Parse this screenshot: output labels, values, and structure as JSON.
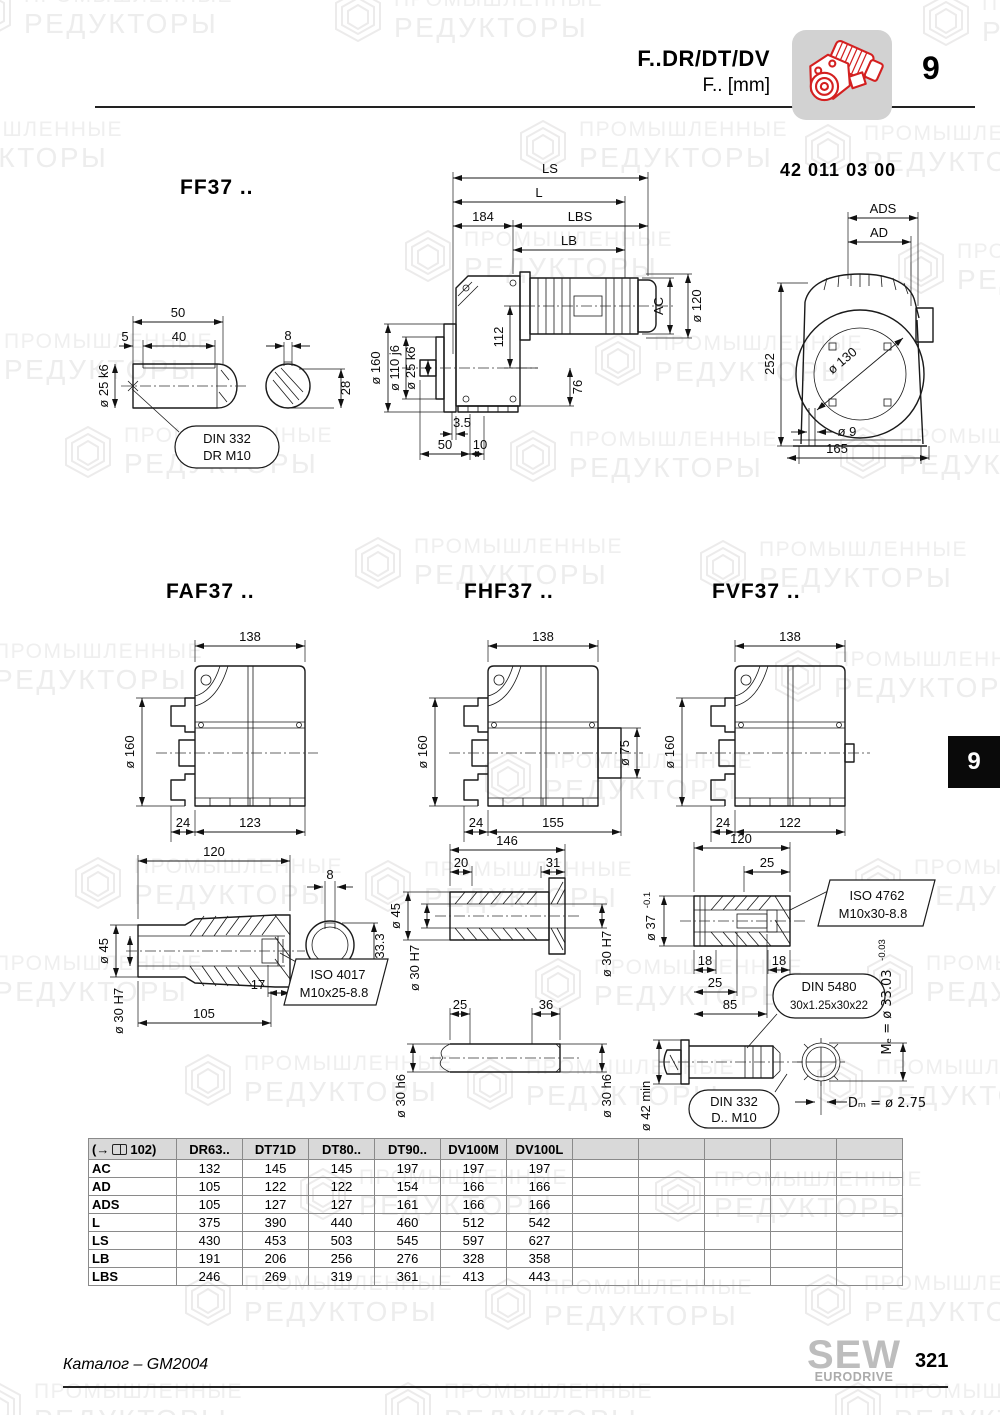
{
  "header": {
    "title1": "F..DR/DT/DV",
    "title2": "F.. [mm]",
    "chapter": "9",
    "part_number": "42 011 03 00"
  },
  "watermark": {
    "line1": "ПРОМЫШЛЕННЫЕ",
    "line2": "РЕДУКТОРЫ"
  },
  "drawings": {
    "ff37": {
      "label": "FF37 ..",
      "shaft": {
        "d50": "50",
        "d5": "5",
        "d40": "40",
        "dia25": "ø 25 k6",
        "d8": "8",
        "d28": "28",
        "callout": [
          "DIN 332",
          "DR M10"
        ]
      },
      "side": {
        "ls": "LS",
        "l": "L",
        "d184": "184",
        "lbs": "LBS",
        "lb": "LB",
        "ac": "AC",
        "dia120": "ø 120",
        "dia160": "ø 160",
        "dia110": "ø 110 j6",
        "dia25": "ø 25 k6",
        "d112": "112",
        "d76": "76",
        "d35": "3.5",
        "d50": "50",
        "d10": "10"
      },
      "front": {
        "ads": "ADS",
        "ad": "AD",
        "d252": "252",
        "dia130": "ø 130",
        "dia9": "ø 9",
        "d165": "165"
      }
    },
    "faf37": {
      "label": "FAF37 ..",
      "d138": "138",
      "dia160": "ø 160",
      "d24": "24",
      "dw": "123"
    },
    "fhf37": {
      "label": "FHF37 ..",
      "d138": "138",
      "dia160": "ø 160",
      "dia75": "ø 75",
      "d24": "24",
      "dw": "155"
    },
    "fvf37": {
      "label": "FVF37 ..",
      "d138": "138",
      "dia160": "ø 160",
      "d24": "24",
      "dw": "122"
    },
    "hollow_a": {
      "d120": "120",
      "d8": "8",
      "d333": "33.3",
      "dia45": "ø 45",
      "dia30": "ø 30 H7",
      "d17": "17",
      "d105": "105",
      "callout": [
        "ISO 4017",
        "M10x25-8.8"
      ]
    },
    "hollow_b": {
      "d146": "146",
      "d20": "20",
      "d31": "31",
      "dia45": "ø 45",
      "dia30l": "ø 30 H7",
      "dia30r": "ø 30 H7",
      "d25": "25",
      "d36": "36",
      "dia30h6l": "ø 30 h6",
      "dia30h6r": "ø 30 h6"
    },
    "hollow_c": {
      "d120": "120",
      "d25": "25",
      "iso": [
        "ISO 4762",
        "M10x30-8.8"
      ],
      "dia37": "ø 37",
      "dia37_tol": "-0.1",
      "d18a": "18",
      "d18b": "18",
      "d25b": "25",
      "d85": "85",
      "din5480": [
        "DIN 5480",
        "30x1.25x30x22"
      ],
      "me": "Mₑ = ø 33.03",
      "me_tol": "-0.03",
      "dia42": "ø 42 min",
      "din332": [
        "DIN 332",
        "D.. M10"
      ],
      "dm": "Dₘ = ø 2.75"
    }
  },
  "table": {
    "ref_prefix": "(→",
    "ref_suffix": "102)",
    "columns": [
      "DR63..",
      "DT71D",
      "DT80..",
      "DT90..",
      "DV100M",
      "DV100L"
    ],
    "rows": [
      {
        "label": "AC",
        "values": [
          "132",
          "145",
          "145",
          "197",
          "197",
          "197"
        ]
      },
      {
        "label": "AD",
        "values": [
          "105",
          "122",
          "122",
          "154",
          "166",
          "166"
        ]
      },
      {
        "label": "ADS",
        "values": [
          "105",
          "127",
          "127",
          "161",
          "166",
          "166"
        ]
      },
      {
        "label": "L",
        "values": [
          "375",
          "390",
          "440",
          "460",
          "512",
          "542"
        ]
      },
      {
        "label": "LS",
        "values": [
          "430",
          "453",
          "503",
          "545",
          "597",
          "627"
        ]
      },
      {
        "label": "LB",
        "values": [
          "191",
          "206",
          "256",
          "276",
          "328",
          "358"
        ]
      },
      {
        "label": "LBS",
        "values": [
          "246",
          "269",
          "319",
          "361",
          "413",
          "443"
        ]
      }
    ]
  },
  "sidetab": {
    "chapter": "9"
  },
  "footer": {
    "catalog": "Каталог – GM2004",
    "page": "321",
    "logo_top": "SEW",
    "logo_bottom": "EURODRIVE"
  },
  "colors": {
    "accent_red": "#d42020",
    "icon_bg": "#d2d2d2",
    "table_header_bg": "#d9d9d9",
    "watermark_text": "#efefef"
  }
}
